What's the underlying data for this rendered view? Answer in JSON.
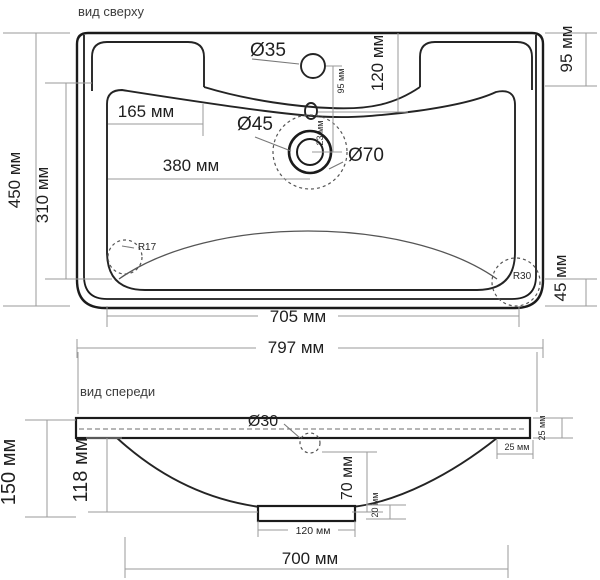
{
  "drawing_title": "sink technical drawing",
  "colors": {
    "background": "#ffffff",
    "main_line": "#1b1b1b",
    "dim_line": "#9a9a9a",
    "text": "#1f1f1f"
  },
  "top_view": {
    "label": "вид сверху",
    "dims": {
      "d35": "Ø35",
      "d120": "120 мм",
      "d95s": "95 мм",
      "d95r": "95 мм",
      "d165": "165 мм",
      "d45": "Ø45",
      "d70": "Ø70",
      "d23": "23 мм",
      "d380": "380 мм",
      "d450": "450 мм",
      "d310": "310 мм",
      "r17": "R17",
      "r30": "R30",
      "d45r": "45 мм",
      "d705": "705 мм",
      "d797": "797 мм"
    }
  },
  "front_view": {
    "label": "вид спереди",
    "dims": {
      "d30": "Ø30",
      "d25r": "25 мм",
      "d25i": "25 мм",
      "d150": "150 мм",
      "d118": "118 мм",
      "d70": "70 мм",
      "d20": "20 мм",
      "d120": "120 мм",
      "d700": "700 мм"
    }
  }
}
